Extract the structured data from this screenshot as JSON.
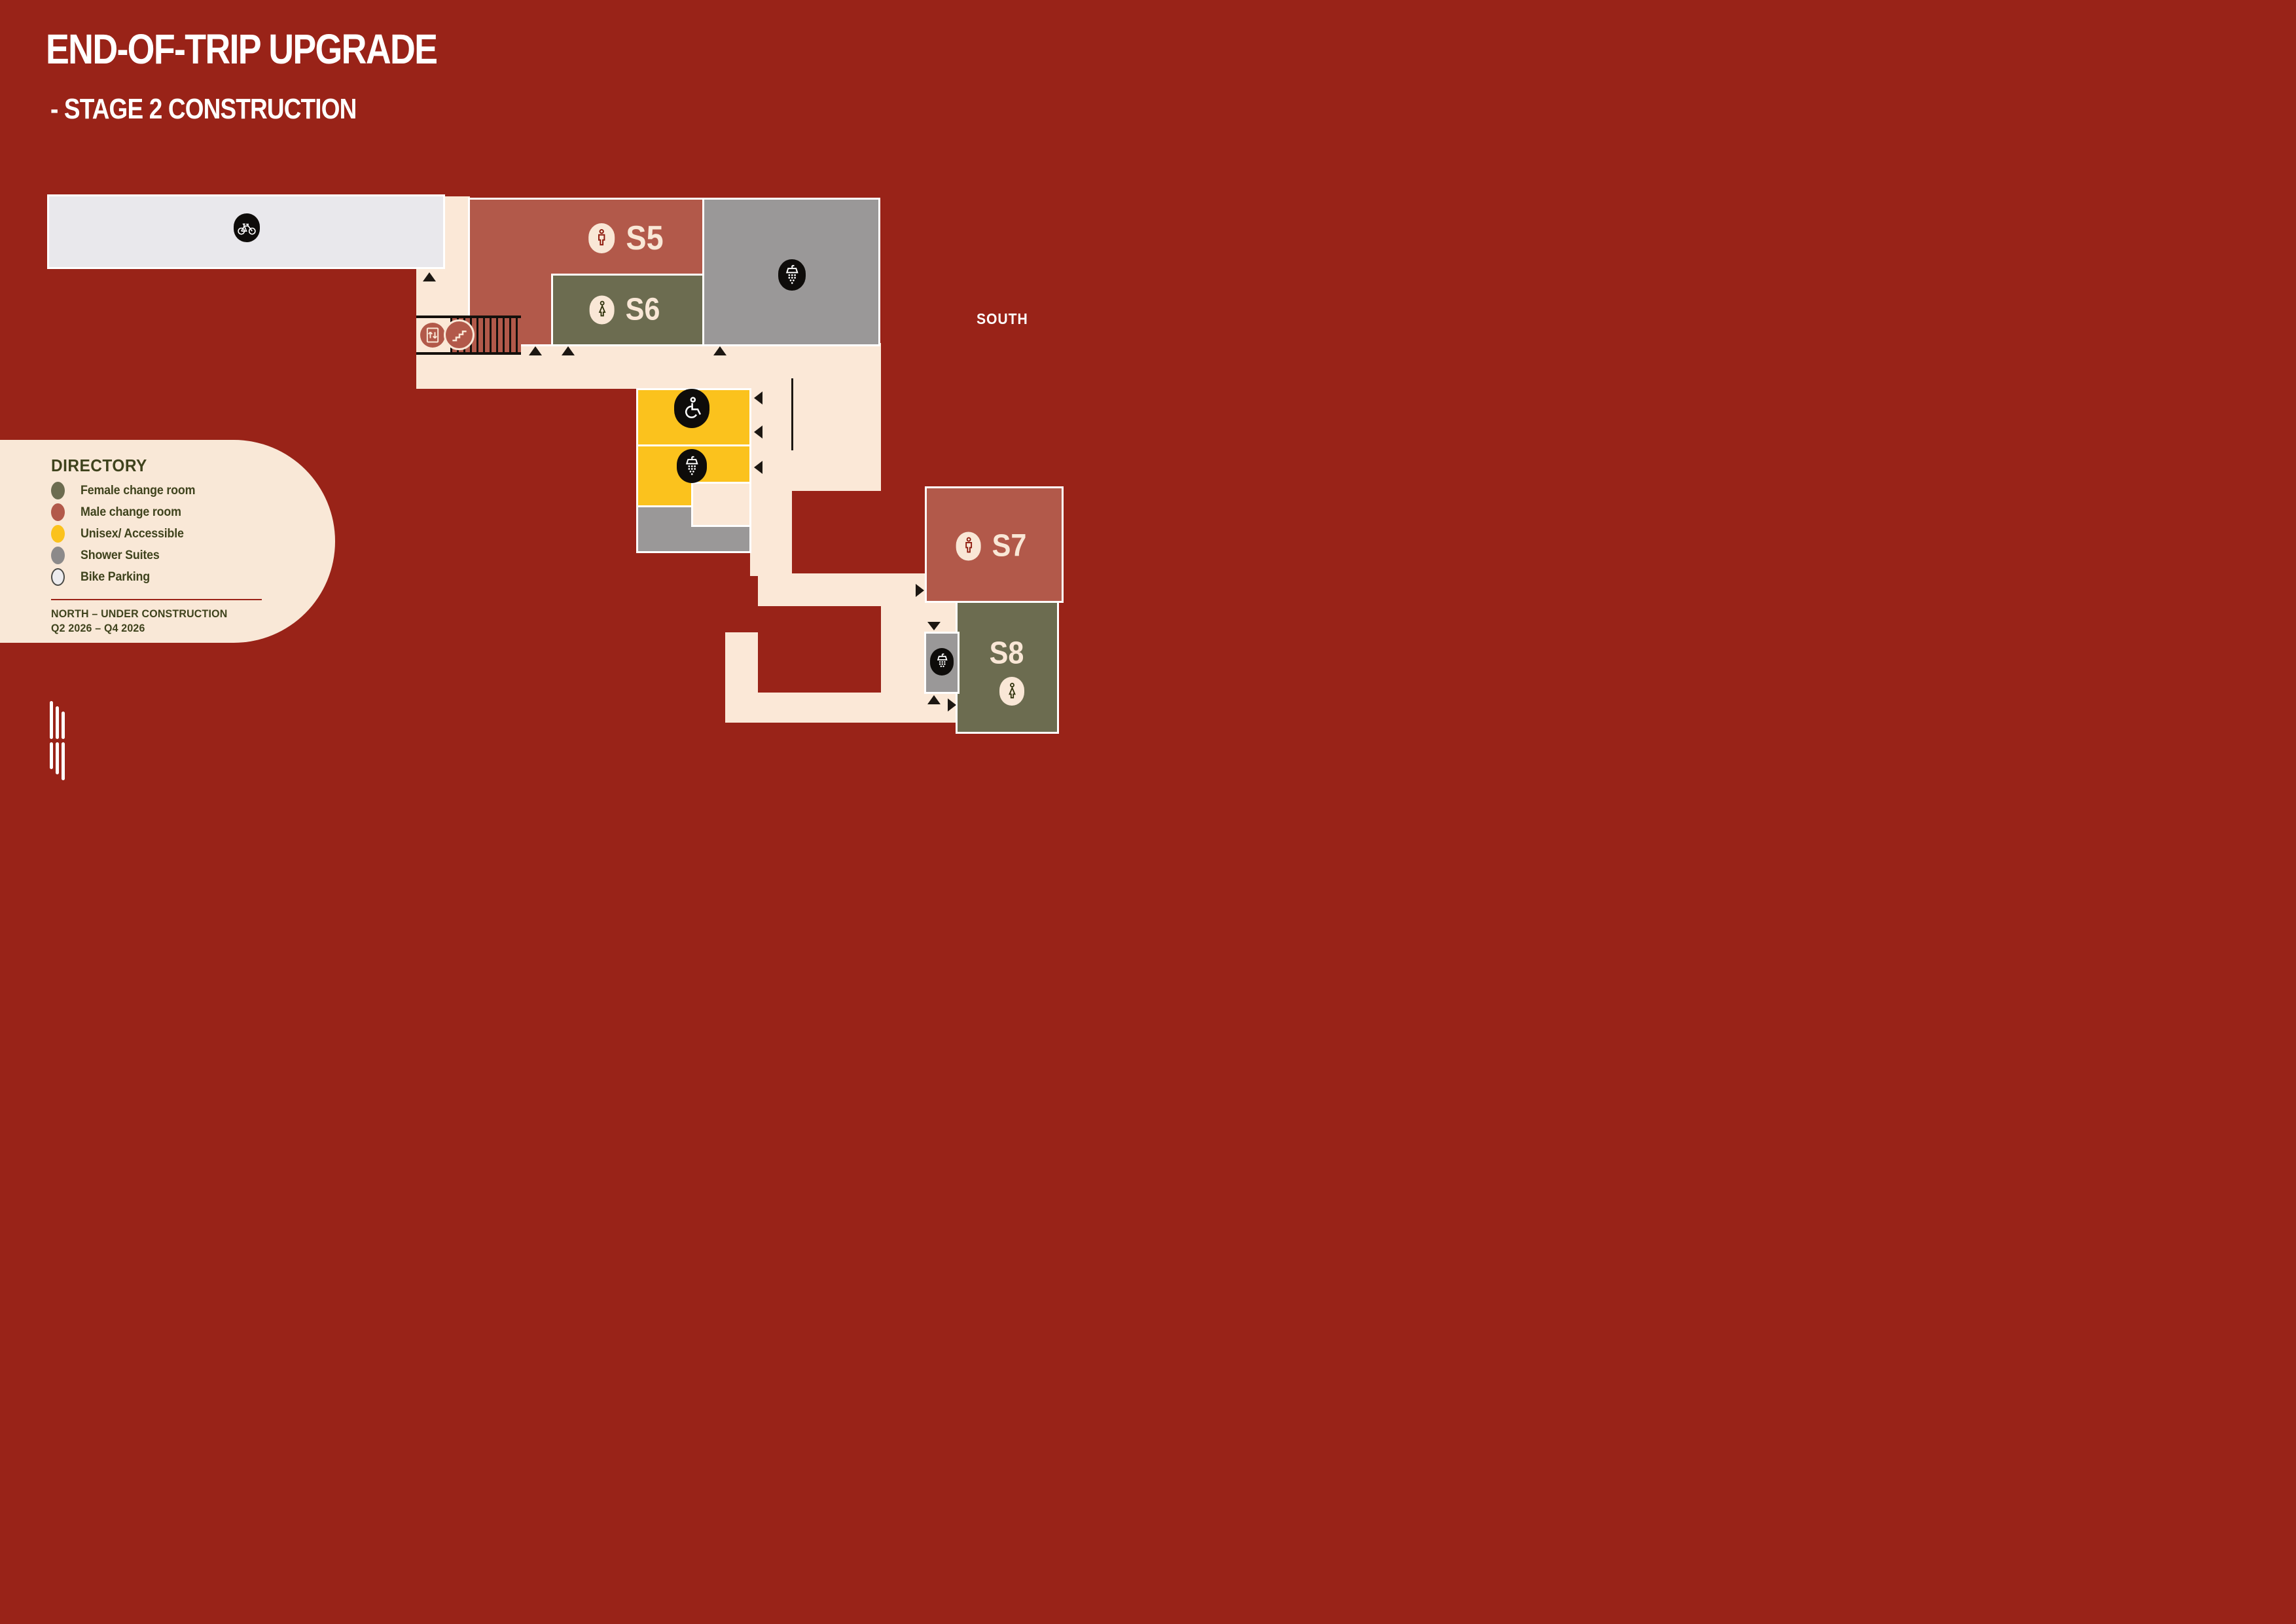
{
  "page": {
    "title": "END-OF-TRIP UPGRADE",
    "subtitle": "- STAGE 2 CONSTRUCTION"
  },
  "compass": {
    "south_label": "SOUTH"
  },
  "directory": {
    "heading": "DIRECTORY",
    "items": [
      {
        "label": "Female change room",
        "color": "#6C6C50",
        "swatch": "female-room-swatch"
      },
      {
        "label": "Male change room",
        "color": "#B2594A",
        "swatch": "male-room-swatch"
      },
      {
        "label": "Unisex/ Accessible",
        "color": "#FBC21D",
        "swatch": "unisex-room-swatch"
      },
      {
        "label": "Shower Suites",
        "color": "#8C8A8A",
        "swatch": "shower-suites-swatch"
      },
      {
        "label": "Bike Parking",
        "color": "#EDECEF",
        "swatch": "bike-parking-swatch"
      }
    ],
    "construction_note": {
      "line1": "NORTH – UNDER CONSTRUCTION",
      "line2": "Q2 2026 – Q4 2026"
    }
  },
  "map": {
    "rooms": [
      {
        "id": "s5",
        "label": "S5",
        "type": "Male change room",
        "icon": "male-icon",
        "color": "#B2594A"
      },
      {
        "id": "s6",
        "label": "S6",
        "type": "Female change room",
        "icon": "female-icon",
        "color": "#6C6C50"
      },
      {
        "id": "s7",
        "label": "S7",
        "type": "Male change room",
        "icon": "male-icon",
        "color": "#B2594A"
      },
      {
        "id": "s8",
        "label": "S8",
        "type": "Female change room",
        "icon": "female-icon",
        "color": "#6C6C50"
      }
    ],
    "facilities": [
      {
        "icon": "bike-icon",
        "area": "bike-parking"
      },
      {
        "icon": "shower-icon",
        "area": "shower-suite-main"
      },
      {
        "icon": "wheelchair-icon",
        "area": "unisex-accessible"
      },
      {
        "icon": "shower-icon",
        "area": "shower-suite-mid"
      },
      {
        "icon": "shower-icon",
        "area": "shower-suite-south"
      },
      {
        "icon": "elevator-icon",
        "area": "lift"
      },
      {
        "icon": "stairs-icon",
        "area": "stairs"
      }
    ],
    "colors": {
      "background": "#992318",
      "walkway": "#FBE8D7",
      "male_room": "#B2594A",
      "female_room": "#6C6C50",
      "unisex_accessible": "#FBC21D",
      "shower_suite": "#9A9898",
      "bike_parking": "#E9E8EC",
      "wall_white": "#FFFFFF",
      "marker_black": "#1C1712"
    }
  }
}
